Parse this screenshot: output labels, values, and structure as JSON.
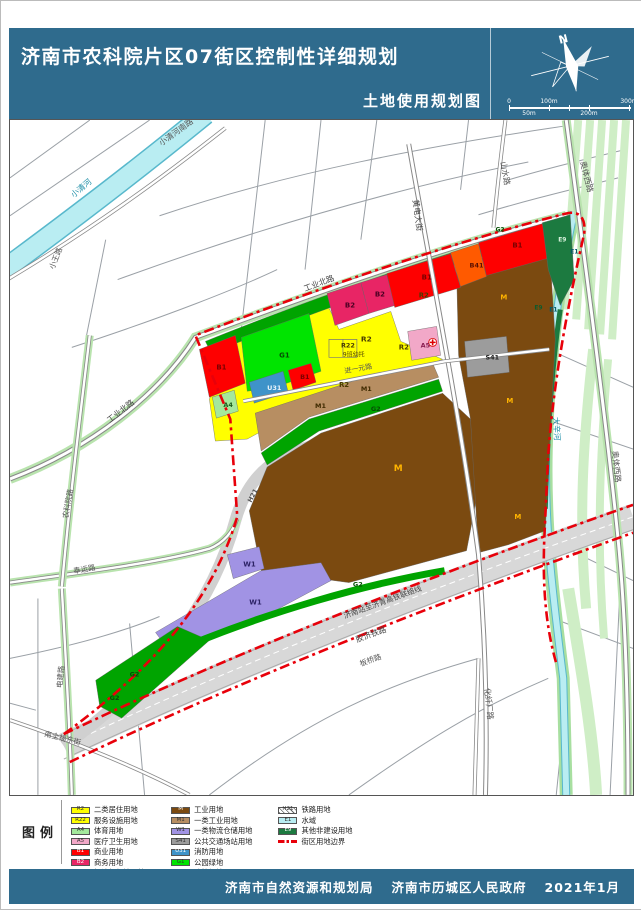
{
  "header": {
    "title": "济南市农科院片区07街区控制性详细规划",
    "subtitle": "土地使用规划图",
    "north_label": "N",
    "scale_ticks_top": [
      "0",
      "100m",
      "300m"
    ],
    "scale_ticks_bottom": [
      "50m",
      "200m"
    ]
  },
  "footer": {
    "agency1": "济南市自然资源和规划局",
    "agency2": "济南市历城区人民政府",
    "date": "2021年1月"
  },
  "colors": {
    "header_bg": "#2f6b8d",
    "boundary_red": "#e8000a",
    "road_line": "#9aa0a6",
    "road_green": "#b9e4ae",
    "river": "#b9edf2",
    "river_edge": "#58b8cc",
    "stripe_green": "#cfeec6",
    "rail_gray": "#d8d8d8",
    "R2": "#ffff00",
    "R22": "#ffff00",
    "A4": "#a4e89c",
    "A5": "#f2a8c8",
    "B1": "#fe0000",
    "B2": "#e82565",
    "B41": "#ff5a00",
    "M": "#7b4a10",
    "M1": "#b78e62",
    "W1": "#a193e4",
    "S41": "#9c9c9c",
    "U31": "#3e93c9",
    "G1": "#00e400",
    "G2": "#00a400",
    "E1": "#b9edf2",
    "E9": "#1c7a40",
    "H21": "#ffffff"
  },
  "legend": {
    "title": "图例",
    "columns": [
      [
        {
          "code": "R2",
          "label": "二类居住用地"
        },
        {
          "code": "R22",
          "label": "服务设施用地"
        },
        {
          "code": "A4",
          "label": "体育用地"
        },
        {
          "code": "A5",
          "label": "医疗卫生用地"
        },
        {
          "code": "B1",
          "label": "商业用地"
        },
        {
          "code": "B2",
          "label": "商务用地"
        },
        {
          "code": "B41",
          "label": "加油加气站用地"
        }
      ],
      [
        {
          "code": "M",
          "label": "工业用地"
        },
        {
          "code": "M1",
          "label": "一类工业用地"
        },
        {
          "code": "W1",
          "label": "一类物流仓储用地"
        },
        {
          "code": "S41",
          "label": "公共交通场站用地"
        },
        {
          "code": "U31",
          "label": "消防用地"
        },
        {
          "code": "G1",
          "label": "公园绿地"
        },
        {
          "code": "G2",
          "label": "防护绿地"
        }
      ],
      [
        {
          "code": "H21",
          "label": "铁路用地",
          "type": "hatch"
        },
        {
          "code": "E1",
          "label": "水域"
        },
        {
          "code": "E9",
          "label": "其他非建设用地"
        },
        {
          "code": "",
          "label": "街区用地边界",
          "type": "boundary"
        }
      ]
    ]
  },
  "map": {
    "labels": [
      {
        "t": "小清河南路",
        "x": 152,
        "y": 26,
        "r": -36,
        "s": 8,
        "c": "#555"
      },
      {
        "t": "小清河",
        "x": 64,
        "y": 78,
        "r": -40,
        "s": 8,
        "c": "#1f8fa8"
      },
      {
        "t": "小王路",
        "x": 44,
        "y": 150,
        "r": -68,
        "s": 7.5,
        "c": "#555"
      },
      {
        "t": "工业北路",
        "x": 100,
        "y": 304,
        "r": -38,
        "s": 8,
        "c": "#444"
      },
      {
        "t": "工业北路",
        "x": 296,
        "y": 172,
        "r": -21,
        "s": 8,
        "c": "#444"
      },
      {
        "t": "山水路",
        "x": 492,
        "y": 42,
        "r": 80,
        "s": 8,
        "c": "#555"
      },
      {
        "t": "黄电大街",
        "x": 404,
        "y": 80,
        "r": 82,
        "s": 8,
        "c": "#444"
      },
      {
        "t": "奥体西路",
        "x": 572,
        "y": 42,
        "r": 76,
        "s": 8,
        "c": "#555"
      },
      {
        "t": "奥体西路",
        "x": 604,
        "y": 332,
        "r": 84,
        "s": 8,
        "c": "#555"
      },
      {
        "t": "大辛河",
        "x": 545,
        "y": 298,
        "r": 87,
        "s": 8,
        "c": "#1f8fa8"
      },
      {
        "t": "农科院路",
        "x": 58,
        "y": 400,
        "r": -80,
        "s": 7.5,
        "c": "#555"
      },
      {
        "t": "奉运路",
        "x": 64,
        "y": 455,
        "r": -10,
        "s": 7.5,
        "c": "#555"
      },
      {
        "t": "电建路",
        "x": 52,
        "y": 570,
        "r": -84,
        "s": 7.5,
        "c": "#555"
      },
      {
        "t": "南全福东街",
        "x": 34,
        "y": 618,
        "r": 14,
        "s": 7.5,
        "c": "#555"
      },
      {
        "t": "进一元路",
        "x": 336,
        "y": 254,
        "r": -10,
        "s": 7,
        "c": "#555"
      },
      {
        "t": "化纤厂路",
        "x": 476,
        "y": 570,
        "r": 84,
        "s": 8,
        "c": "#555"
      },
      {
        "t": "济南站至济青高铁联络线",
        "x": 336,
        "y": 500,
        "r": -20,
        "s": 7.5,
        "c": "#444"
      },
      {
        "t": "胶济铁路",
        "x": 348,
        "y": 524,
        "r": -20,
        "s": 8,
        "c": "#444"
      },
      {
        "t": "板桥路",
        "x": 352,
        "y": 548,
        "r": -20,
        "s": 7.5,
        "c": "#555"
      },
      {
        "t": "H21",
        "x": 242,
        "y": 384,
        "r": -62,
        "s": 6.5,
        "c": "#555",
        "b": 1
      },
      {
        "t": "B1",
        "x": 207,
        "y": 250,
        "s": 7,
        "c": "#7a0000",
        "b": 1
      },
      {
        "t": "B2",
        "x": 336,
        "y": 188,
        "s": 7,
        "c": "#4a0022",
        "b": 1
      },
      {
        "t": "B2",
        "x": 366,
        "y": 177,
        "s": 7,
        "c": "#4a0022",
        "b": 1
      },
      {
        "t": "B1",
        "x": 413,
        "y": 160,
        "s": 7,
        "c": "#7a0000",
        "b": 1
      },
      {
        "t": "B41",
        "x": 461,
        "y": 148,
        "s": 6.5,
        "c": "#5a1000",
        "b": 1
      },
      {
        "t": "B1",
        "x": 504,
        "y": 128,
        "s": 7,
        "c": "#7a0000",
        "b": 1
      },
      {
        "t": "E9",
        "x": 550,
        "y": 122,
        "s": 6,
        "c": "#d8f2dc",
        "b": 1
      },
      {
        "t": "E1",
        "x": 562,
        "y": 134,
        "s": 6,
        "c": "#055a66",
        "b": 1
      },
      {
        "t": "E9",
        "x": 526,
        "y": 190,
        "s": 6,
        "c": "#0f5a2c",
        "b": 1
      },
      {
        "t": "E1",
        "x": 541,
        "y": 192,
        "s": 6,
        "c": "#055a66",
        "b": 1
      },
      {
        "t": "G1",
        "x": 270,
        "y": 238,
        "s": 7,
        "c": "#044d04",
        "b": 1
      },
      {
        "t": "A4",
        "x": 214,
        "y": 288,
        "s": 6.5,
        "c": "#1d5c1d",
        "b": 1
      },
      {
        "t": "U31",
        "x": 258,
        "y": 271,
        "s": 6.5,
        "c": "#eaf4fb",
        "b": 1
      },
      {
        "t": "B1",
        "x": 291,
        "y": 260,
        "s": 6.5,
        "c": "#7a0000",
        "b": 1
      },
      {
        "t": "R2",
        "x": 352,
        "y": 222,
        "s": 7.5,
        "c": "#4a3c00",
        "b": 1
      },
      {
        "t": "R2",
        "x": 410,
        "y": 178,
        "s": 7,
        "c": "#4a3c00",
        "b": 1
      },
      {
        "t": "R2",
        "x": 390,
        "y": 230,
        "s": 7,
        "c": "#4a3c00",
        "b": 1
      },
      {
        "t": "R2",
        "x": 330,
        "y": 268,
        "s": 7,
        "c": "#4a3c00",
        "b": 1
      },
      {
        "t": "R22",
        "x": 332,
        "y": 228,
        "s": 6.5,
        "c": "#4a3c00",
        "b": 1
      },
      {
        "t": "9班幼托",
        "x": 334,
        "y": 237,
        "s": 6,
        "c": "#4a3c00"
      },
      {
        "t": "A5",
        "x": 412,
        "y": 228,
        "s": 6.5,
        "c": "#8a1f52",
        "b": 1
      },
      {
        "t": "M",
        "x": 492,
        "y": 180,
        "s": 7,
        "c": "#ffb400",
        "b": 1
      },
      {
        "t": "M",
        "x": 498,
        "y": 284,
        "s": 7,
        "c": "#ffb400",
        "b": 1
      },
      {
        "t": "M",
        "x": 385,
        "y": 352,
        "s": 9,
        "c": "#ffb400",
        "b": 1
      },
      {
        "t": "M",
        "x": 506,
        "y": 400,
        "s": 7,
        "c": "#ffb400",
        "b": 1
      },
      {
        "t": "M1",
        "x": 352,
        "y": 272,
        "s": 6.5,
        "c": "#3f2a00",
        "b": 1
      },
      {
        "t": "M1",
        "x": 306,
        "y": 289,
        "s": 6.5,
        "c": "#3f2a00",
        "b": 1
      },
      {
        "t": "G2",
        "x": 362,
        "y": 292,
        "s": 6.5,
        "c": "#044d04",
        "b": 1
      },
      {
        "t": "G2",
        "x": 344,
        "y": 468,
        "s": 6.5,
        "c": "#044d04",
        "b": 1
      },
      {
        "t": "G2",
        "x": 120,
        "y": 558,
        "s": 6.5,
        "c": "#044d04",
        "b": 1
      },
      {
        "t": "G2",
        "x": 100,
        "y": 582,
        "s": 6.5,
        "c": "#044d04",
        "b": 1
      },
      {
        "t": "G2",
        "x": 487,
        "y": 112,
        "s": 6,
        "c": "#044d04",
        "b": 1
      },
      {
        "t": "S41",
        "x": 477,
        "y": 240,
        "s": 6.5,
        "c": "#222",
        "b": 1
      },
      {
        "t": "W1",
        "x": 234,
        "y": 448,
        "s": 7,
        "c": "#2d2366",
        "b": 1
      },
      {
        "t": "W1",
        "x": 240,
        "y": 486,
        "s": 7,
        "c": "#2d2366",
        "b": 1
      }
    ]
  }
}
